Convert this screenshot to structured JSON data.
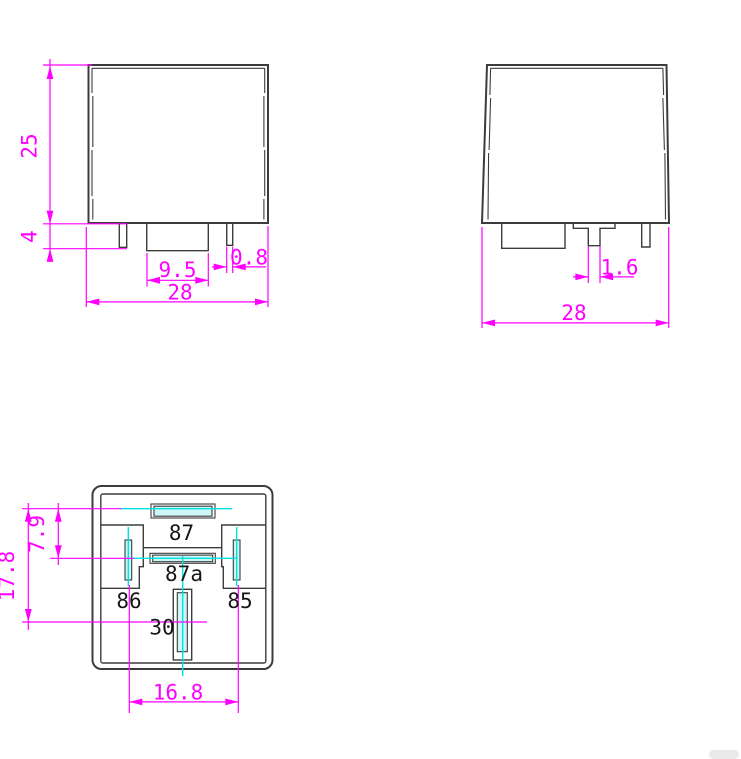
{
  "drawing": {
    "title": "automotive relay outline drawing",
    "front_view": {
      "body_height": "25",
      "pin_protrusion": "4",
      "center_tab_width": "9.5",
      "pin_thickness": "0.8",
      "body_width": "28"
    },
    "side_view": {
      "pin_width": "1.6",
      "body_width": "28"
    },
    "bottom_view": {
      "overall_span": "17.8",
      "row_spacing": "7.9",
      "pin_spacing": "16.8",
      "pin_labels": {
        "pin87": "87",
        "pin87a": "87a",
        "pin86": "86",
        "pin85": "85",
        "pin30": "30"
      }
    }
  },
  "colors": {
    "dimension_magenta": "#ff00ff",
    "centerline_cyan": "#00e1e1",
    "outline_black": "#3c3c3c",
    "slot_fill_cyan": "#cdf6f6"
  }
}
